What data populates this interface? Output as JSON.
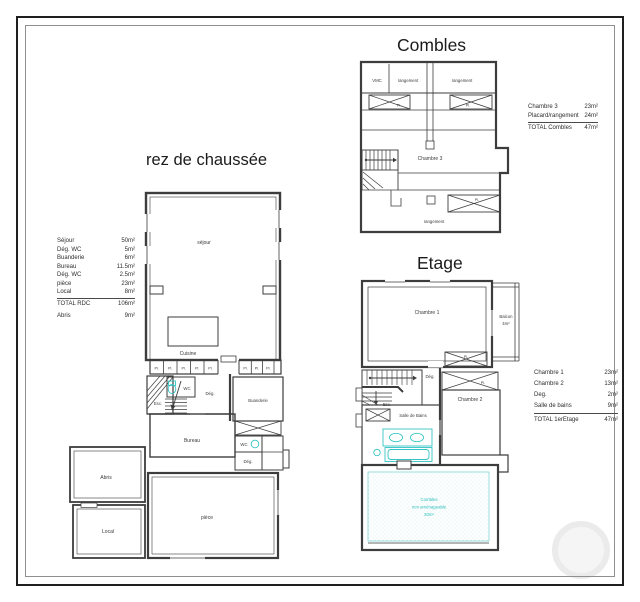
{
  "titles": {
    "rdc": "rez de chaussée",
    "combles": "Combles",
    "etage": "Etage"
  },
  "rdc": {
    "legend": {
      "rows": [
        {
          "label": "Séjour",
          "value": "50m²"
        },
        {
          "label": "Dég. WC",
          "value": "5m²"
        },
        {
          "label": "Buanderie",
          "value": "6m²"
        },
        {
          "label": "Bureau",
          "value": "11.5m²"
        },
        {
          "label": "Dég. WC",
          "value": "2.5m²"
        },
        {
          "label": "pièce",
          "value": "23m²"
        },
        {
          "label": "Local",
          "value": "8m²"
        }
      ],
      "total": {
        "label": "TOTAL RDC",
        "value": "106m²"
      },
      "extra": {
        "label": "Abris",
        "value": "9m²"
      }
    },
    "rooms": {
      "sejour": "séjour",
      "cuisine": "Cuisine",
      "pl": "Pl.",
      "esc": "Esc.",
      "wc": "WC",
      "deg": "Dég.",
      "buanderie": "Buanderie",
      "bureau": "Bureau",
      "wc2": "WC",
      "deg2": "Dég.",
      "abris": "Abris",
      "local": "Local",
      "piece": "pièce"
    }
  },
  "combles": {
    "legend": {
      "rows": [
        {
          "label": "Chambre 3",
          "value": "23m²"
        },
        {
          "label": "Placard/rangement",
          "value": "24m²"
        }
      ],
      "total": {
        "label": "TOTAL Combles",
        "value": "47m²"
      }
    },
    "rooms": {
      "vmc": "VMC",
      "rangement1": "rangement",
      "rangement2": "rangement",
      "chambre3": "Chambre 3",
      "rangement3": "rangement",
      "pl": "Pl."
    }
  },
  "etage": {
    "legend": {
      "rows": [
        {
          "label": "Chambre 1",
          "value": "23m²"
        },
        {
          "label": "Chambre 2",
          "value": "13m²"
        },
        {
          "label": "Deg.",
          "value": "2m²"
        },
        {
          "label": "Salle de bains",
          "value": "9m²"
        }
      ],
      "total": {
        "label": "TOTAL 1erEtage",
        "value": "47m²"
      }
    },
    "rooms": {
      "chambre1": "Chambre 1",
      "balcon": "Balcon",
      "balcon_area": "4m²",
      "deg": "Dég.",
      "esc": "Esc.",
      "chambre2": "Chambre 2",
      "sdb": "Salle de Bains",
      "pl": "Pl.",
      "combles1": "Combles",
      "combles2": "non aménageable",
      "combles3": "20m²"
    }
  }
}
